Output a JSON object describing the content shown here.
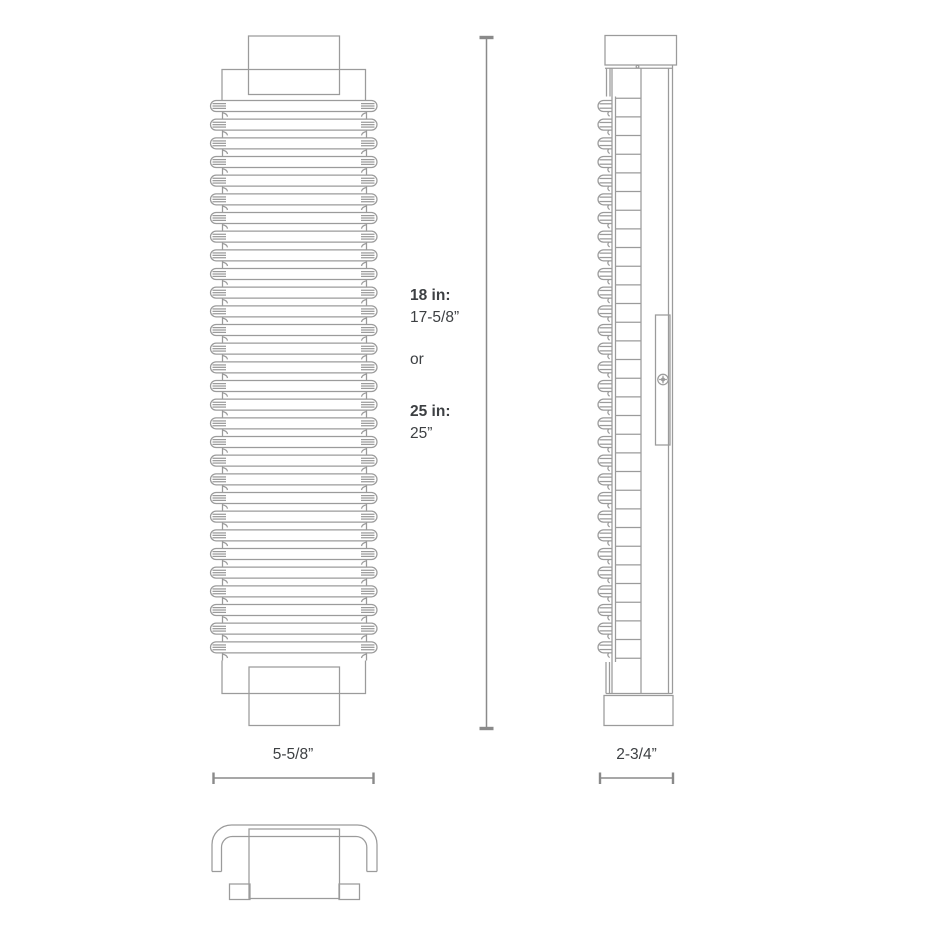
{
  "diagram": {
    "height_dimension": {
      "option1_label": "18 in:",
      "option1_value": "17-5/8”",
      "separator": "or",
      "option2_label": "25 in:",
      "option2_value": "25”"
    },
    "width_dimension": {
      "label": "5-5/8”"
    },
    "depth_dimension": {
      "label": "2-3/4”"
    }
  },
  "icons": {
    "screw": "phillips-screw-icon"
  },
  "colors": {
    "line": "#9b9b9b",
    "dimension": "#8a8a8a",
    "text": "#3d4043",
    "background": "#ffffff"
  }
}
